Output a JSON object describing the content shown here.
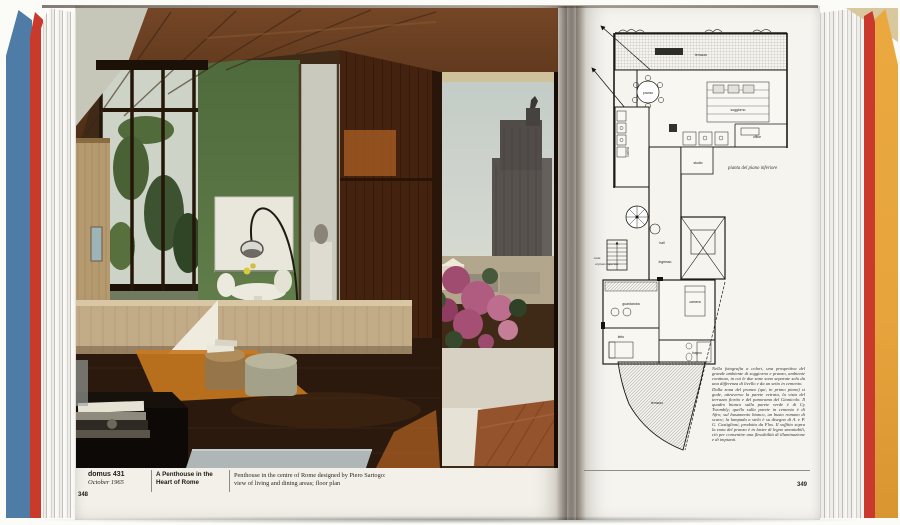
{
  "book": {
    "colors": {
      "cover_blue": "#4e7ca6",
      "cover_red": "#c93a2c",
      "cover_orange": "#e7a43d"
    },
    "left_page": {
      "page_number": "348",
      "journal": "domus 431",
      "issue_date": "October 1965",
      "article_title_line1": "A Penthouse in the",
      "article_title_line2": "Heart of Rome",
      "caption_line1": "Penthouse in the centre of Rome designed by Piero Sartogo:",
      "caption_line2": "view of living and dining areas; floor plan"
    },
    "right_page": {
      "page_number": "349",
      "plan_caption": "pianta del piano inferiore",
      "plan_labels": [
        {
          "text": "terrazzo",
          "x": 116,
          "y": 44
        },
        {
          "text": "pranzo",
          "x": 63,
          "y": 82
        },
        {
          "text": "soggiorno",
          "x": 153,
          "y": 99
        },
        {
          "text": "cucina",
          "x": 44,
          "y": 140,
          "rot": -90
        },
        {
          "text": "office",
          "x": 172,
          "y": 126
        },
        {
          "text": "studio",
          "x": 113,
          "y": 152
        },
        {
          "text": "hall",
          "x": 77,
          "y": 232
        },
        {
          "text": "ingresso",
          "x": 80,
          "y": 251
        },
        {
          "text": "scala",
          "x": 12,
          "y": 247,
          "italic": true
        },
        {
          "text": "al piano superiore",
          "x": 22,
          "y": 253,
          "italic": true
        },
        {
          "text": "guardaroba",
          "x": 46,
          "y": 293
        },
        {
          "text": "camera",
          "x": 110,
          "y": 291
        },
        {
          "text": "letto",
          "x": 36,
          "y": 326
        },
        {
          "text": "bagno",
          "x": 112,
          "y": 342
        },
        {
          "text": "terrazzo",
          "x": 72,
          "y": 392
        }
      ],
      "body_text_p1": "Nella fotografia a colori, una prospettiva del grande ambiente di soggiorno e pranzo, ambiente continuo, in cui le due zone sono separate solo da una differenza di livello e da un setto in cemento.",
      "body_text_p2": "Dalla zona del pranzo (qui, in primo piano) si gode, attraverso la parete vetrata, la vista del terrazzo fiorito e del panorama del Gianicolo. Il quadro bianco sulla parete verde è di Cy Twombly; quello sulla parete in cemento è di Afro; sul basamento bianco, un busto romano di scavo; la lampada a stelo è su disegno di A. e P. G. Castiglioni, prodotta da Flos. Il soffitto sopra la zona del pranzo è in lastre di legno smontabili, ciò per consentire una flessibilità di illuminazione e di impianti."
    }
  }
}
